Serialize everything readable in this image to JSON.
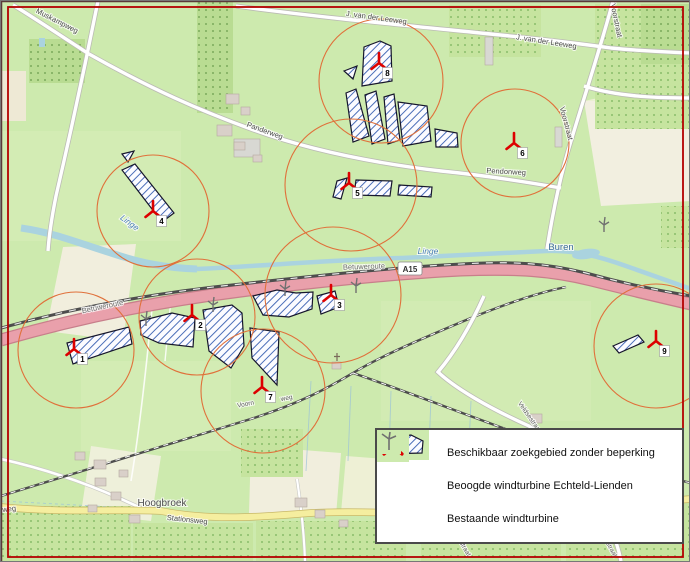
{
  "legend": {
    "items": [
      {
        "id": "search-area",
        "label": "Beschikbaar zoekgebied zonder beperking"
      },
      {
        "id": "proposed-turbine",
        "label": "Beoogde windturbine Echteld-Lienden"
      },
      {
        "id": "existing-turbine",
        "label": "Bestaande windturbine"
      }
    ]
  },
  "map": {
    "highway_shield": "A15",
    "labels": [
      {
        "text": "Muskampweg",
        "x": 55,
        "y": 22,
        "rot": 27,
        "kind": "road"
      },
      {
        "text": "J. van der Leeweg",
        "x": 375,
        "y": 19,
        "rot": 8,
        "kind": "road"
      },
      {
        "text": "J. van der Leeweg",
        "x": 545,
        "y": 43,
        "rot": 9,
        "kind": "road"
      },
      {
        "text": "Panderweg",
        "x": 263,
        "y": 132,
        "rot": 20,
        "kind": "road"
      },
      {
        "text": "Pendonweg",
        "x": 505,
        "y": 173,
        "rot": 3,
        "kind": "road"
      },
      {
        "text": "Voorstraat",
        "x": 613,
        "y": 20,
        "rot": 78,
        "kind": "road"
      },
      {
        "text": "Voorstraat",
        "x": 563,
        "y": 123,
        "rot": 75,
        "kind": "road"
      },
      {
        "text": "Betuweroute",
        "x": 102,
        "y": 308,
        "rot": -12,
        "kind": "rail"
      },
      {
        "text": "Betuweroute",
        "x": 363,
        "y": 268,
        "rot": -2,
        "kind": "rail"
      },
      {
        "text": "A15",
        "x": 409,
        "y": 268,
        "rot": 0,
        "kind": "shield"
      },
      {
        "text": "Linge",
        "x": 127,
        "y": 224,
        "rot": 36,
        "kind": "water"
      },
      {
        "text": "Linge",
        "x": 427,
        "y": 253,
        "rot": 0,
        "kind": "water"
      },
      {
        "text": "Buren",
        "x": 560,
        "y": 249,
        "rot": 0,
        "kind": "water_place"
      },
      {
        "text": "Hoogbroek",
        "x": 161,
        "y": 505,
        "rot": 0,
        "kind": "place"
      },
      {
        "text": "Stationsweg",
        "x": 186,
        "y": 521,
        "rot": 6,
        "kind": "road"
      },
      {
        "text": "Stationsweg",
        "x": -5,
        "y": 512,
        "rot": -7,
        "kind": "road"
      },
      {
        "text": "Voorn",
        "x": 245,
        "y": 405,
        "rot": -11,
        "kind": "road_small"
      },
      {
        "text": "weg",
        "x": 286,
        "y": 399,
        "rot": -11,
        "kind": "road_small"
      },
      {
        "text": "Veldsestraat",
        "x": 527,
        "y": 417,
        "rot": 55,
        "kind": "road_small"
      },
      {
        "text": "Molenstraat",
        "x": 458,
        "y": 541,
        "rot": 60,
        "kind": "road_small"
      },
      {
        "text": "Veldsestraat",
        "x": 604,
        "y": 541,
        "rot": 60,
        "kind": "road_small"
      }
    ],
    "proposed_turbines": [
      {
        "num": "1",
        "x": 73,
        "y": 348
      },
      {
        "num": "2",
        "x": 191,
        "y": 314
      },
      {
        "num": "3",
        "x": 330,
        "y": 294
      },
      {
        "num": "4",
        "x": 152,
        "y": 210
      },
      {
        "num": "5",
        "x": 348,
        "y": 182
      },
      {
        "num": "6",
        "x": 513,
        "y": 142
      },
      {
        "num": "7",
        "x": 261,
        "y": 386
      },
      {
        "num": "8",
        "x": 378,
        "y": 62
      },
      {
        "num": "9",
        "x": 655,
        "y": 340
      }
    ],
    "existing_turbines": [
      {
        "x": 145,
        "y": 316
      },
      {
        "x": 212,
        "y": 302
      },
      {
        "x": 284,
        "y": 286
      },
      {
        "x": 355,
        "y": 283
      },
      {
        "x": 603,
        "y": 222
      }
    ],
    "radius_circles": [
      {
        "cx": 75,
        "cy": 349,
        "r": 58
      },
      {
        "cx": 196,
        "cy": 316,
        "r": 58
      },
      {
        "cx": 332,
        "cy": 294,
        "r": 68
      },
      {
        "cx": 152,
        "cy": 210,
        "r": 56
      },
      {
        "cx": 350,
        "cy": 184,
        "r": 66
      },
      {
        "cx": 514,
        "cy": 142,
        "r": 54
      },
      {
        "cx": 262,
        "cy": 390,
        "r": 62
      },
      {
        "cx": 380,
        "cy": 80,
        "r": 62
      },
      {
        "cx": 655,
        "cy": 345,
        "r": 62
      }
    ],
    "search_area_paths": [
      "M66,342 L128,326 L131,343 L72,363 Z",
      "M139,320 L171,312 L194,317 L192,346 L158,342 L140,334 Z",
      "M202,309 L231,304 L241,312 L243,345 L230,367 L208,350 Z",
      "M249,327 L278,331 L276,384 L251,357 Z",
      "M252,295 L276,289 L295,292 L312,291 L311,308 L288,316 L262,314 Z",
      "M316,295 L334,290 L338,306 L320,313 Z",
      "M121,169 L134,163 L173,212 L161,221 Z",
      "M121,153 L133,150 L127,161 Z",
      "M363,46 L379,40 L390,45 L391,80 L361,85 Z",
      "M343,70 L356,65 L352,78 Z",
      "M345,92 L355,88 L368,135 L352,141 Z",
      "M364,94 L375,90 L384,138 L371,143 Z",
      "M383,96 L393,93 L399,139 L387,143 Z",
      "M397,101 L426,105 L430,140 L402,145 Z",
      "M434,128 L456,132 L457,146 L435,146 Z",
      "M336,180 L346,177 L340,198 L332,196 Z",
      "M355,179 L391,180 L389,195 L353,194 Z",
      "M398,184 L431,186 L430,196 L397,194 Z",
      "M612,345 L637,334 L643,341 L618,352 Z"
    ]
  },
  "colors": {
    "map_green": "#cdeaae",
    "orchard_green": "#c6e49f",
    "orchard_dot": "#8abc6a",
    "field_beige": "#f1eedd",
    "water": "#aad3df",
    "motorway": "#e9a0ab",
    "motorway_casing": "#c87f8b",
    "road_yellow": "#f5ee9f",
    "railway": "#4d4d4d",
    "radius_circle": "#e0703a",
    "proposed_turbine": "#dd0000",
    "existing_turbine": "#707070",
    "hatch_line": "#4a6db8",
    "search_border": "#16162c",
    "map_border": "#b40000"
  }
}
